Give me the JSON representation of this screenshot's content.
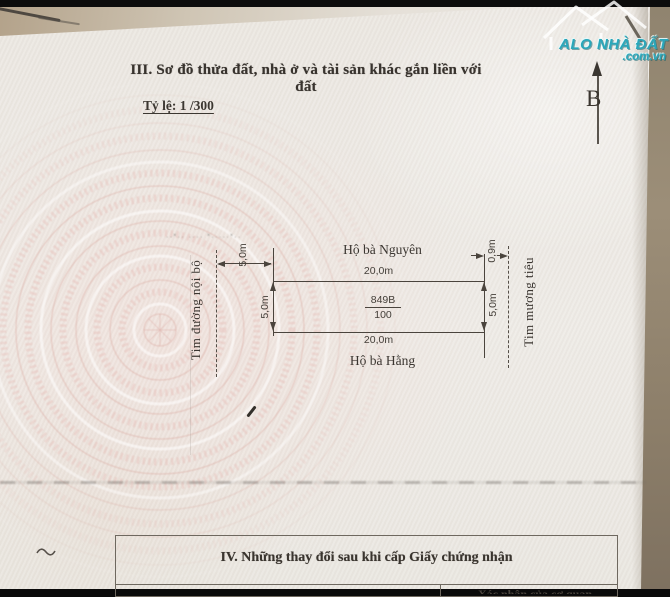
{
  "page": {
    "section3": {
      "title": "III. Sơ đồ thửa đất, nhà ở và tài sản khác gắn liền với đất",
      "scale": "Tỷ lệ: 1 /300"
    },
    "watermark": {
      "brand": "ALO NHÀ ĐẤT",
      "suffix": ".com.vn"
    },
    "compass": {
      "north_label": "B"
    },
    "serial_faint": "··˟·· ···· ˟·····˟··",
    "diagram": {
      "neighbor_top": "Hộ bà Nguyên",
      "neighbor_bottom": "Hộ bà Hằng",
      "road_centerline": "Tim đường nội bộ",
      "ditch_centerline": "Tim mương tiêu",
      "width_top": "20,0m",
      "width_bottom": "20,0m",
      "depth_left": "5,0m",
      "depth_right": "5,0m",
      "offset_left": "5,0m",
      "offset_right": "0,9m",
      "parcel_number": "849B",
      "parcel_area": "100"
    },
    "section4": {
      "title": "IV. Những thay đổi sau khi cấp Giấy chứng nhận",
      "partial_header": "Xác nhận của cơ quan"
    }
  }
}
